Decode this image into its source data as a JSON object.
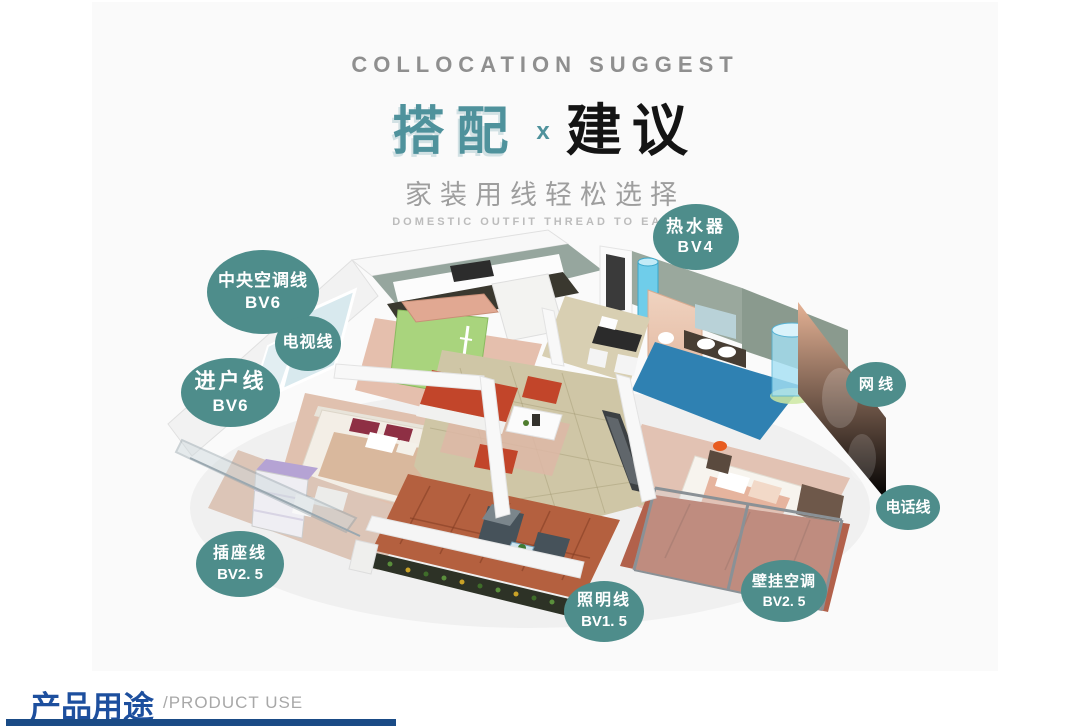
{
  "header": {
    "eyebrow": "COLLOCATION SUGGEST",
    "title_left": "搭配",
    "title_x": "x",
    "title_right": "建议",
    "subtitle": "家装用线轻松选择",
    "subtitle_en": "DOMESTIC OUTFIT THREAD TO EASILY",
    "accent_color": "#4f929c"
  },
  "callouts": {
    "color": "#4e8d8b",
    "items": [
      {
        "id": "water-heater",
        "label": "热水器",
        "spec": "BV4"
      },
      {
        "id": "central-ac-line",
        "label": "中央空调线",
        "spec": "BV6"
      },
      {
        "id": "tv-line",
        "label": "电视线",
        "spec": ""
      },
      {
        "id": "entry-line",
        "label": "进户线",
        "spec": "BV6"
      },
      {
        "id": "network-line",
        "label": "网 线",
        "spec": ""
      },
      {
        "id": "phone-line",
        "label": "电话线",
        "spec": ""
      },
      {
        "id": "socket-line",
        "label": "插座线",
        "spec": "BV2. 5"
      },
      {
        "id": "wall-ac",
        "label": "壁挂空调",
        "spec": "BV2. 5"
      },
      {
        "id": "lighting-line",
        "label": "照明线",
        "spec": "BV1. 5"
      }
    ]
  },
  "footer": {
    "title": "产品用途",
    "subtitle": "/PRODUCT USE",
    "bar_color": "#1a4b86",
    "title_color": "#1d4f9e"
  }
}
